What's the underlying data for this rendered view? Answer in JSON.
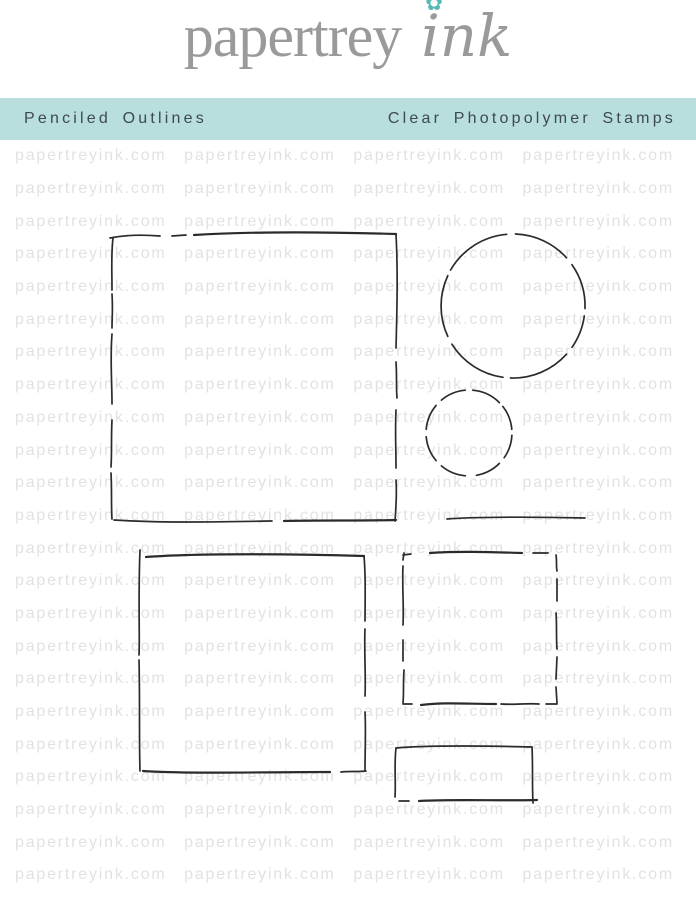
{
  "logo": {
    "name_serif": "papertrey",
    "name_script": "ink",
    "text_color": "#9a9a9a",
    "flower_icon": "✿",
    "flower_color": "#54bab5"
  },
  "banner": {
    "product_name": "Penciled Outlines",
    "product_type": "Clear Photopolymer Stamps",
    "background_color": "#b8dedd",
    "text_color": "#3e4a4b"
  },
  "watermark": {
    "text": "papertreyink.com",
    "color": "#e2e2e2",
    "rows": 23,
    "columns": 4
  },
  "stamps": {
    "stroke_color": "#2b2b2b",
    "items": [
      {
        "name": "large-square",
        "shape": "square"
      },
      {
        "name": "large-circle",
        "shape": "circle"
      },
      {
        "name": "small-circle",
        "shape": "circle"
      },
      {
        "name": "straight-line",
        "shape": "line"
      },
      {
        "name": "large-rectangle",
        "shape": "rectangle"
      },
      {
        "name": "medium-square",
        "shape": "square"
      },
      {
        "name": "small-rectangle",
        "shape": "rectangle"
      }
    ]
  }
}
